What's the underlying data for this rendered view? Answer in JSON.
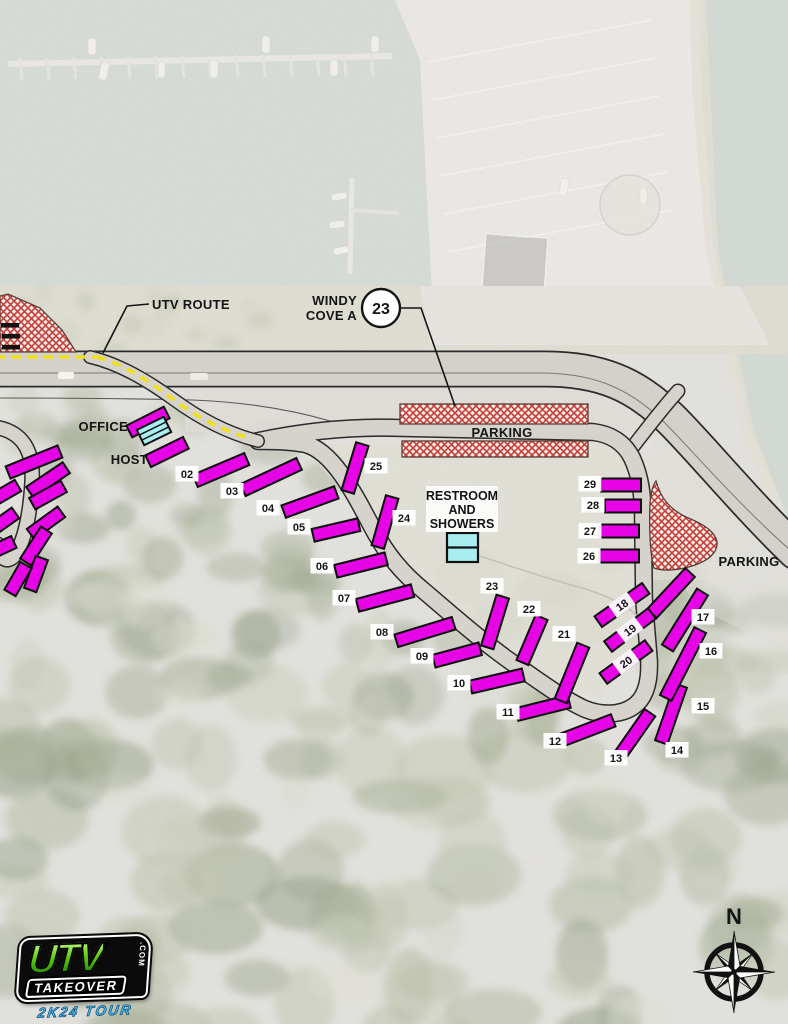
{
  "labels": {
    "utv_route": "UTV ROUTE",
    "windy_line1": "WINDY",
    "windy_line2": "COVE A",
    "cove_number": "23",
    "office": "OFFICE",
    "host": "HOST",
    "parking_top": "PARKING",
    "parking_right": "PARKING",
    "restroom_line1": "RESTROOM",
    "restroom_line2": "AND",
    "restroom_line3": "SHOWERS",
    "north": "N"
  },
  "sites": [
    {
      "n": "02",
      "x": 221,
      "y": 470,
      "len": 56,
      "a": -23,
      "lx": 187,
      "ly": 474,
      "on": false
    },
    {
      "n": "03",
      "x": 271,
      "y": 477,
      "len": 62,
      "a": -25,
      "lx": 232,
      "ly": 491,
      "on": false
    },
    {
      "n": "04",
      "x": 310,
      "y": 502,
      "len": 56,
      "a": -20,
      "lx": 268,
      "ly": 508,
      "on": false
    },
    {
      "n": "05",
      "x": 336,
      "y": 530,
      "len": 47,
      "a": -13,
      "lx": 299,
      "ly": 527,
      "on": false
    },
    {
      "n": "06",
      "x": 361,
      "y": 565,
      "len": 52,
      "a": -14,
      "lx": 322,
      "ly": 566,
      "on": false
    },
    {
      "n": "07",
      "x": 385,
      "y": 598,
      "len": 57,
      "a": -15,
      "lx": 344,
      "ly": 598,
      "on": false
    },
    {
      "n": "08",
      "x": 425,
      "y": 632,
      "len": 60,
      "a": -17,
      "lx": 382,
      "ly": 632,
      "on": false
    },
    {
      "n": "09",
      "x": 457,
      "y": 655,
      "len": 48,
      "a": -15,
      "lx": 422,
      "ly": 656,
      "on": false
    },
    {
      "n": "10",
      "x": 497,
      "y": 681,
      "len": 54,
      "a": -13,
      "lx": 459,
      "ly": 683,
      "on": false
    },
    {
      "n": "11",
      "x": 543,
      "y": 708,
      "len": 54,
      "a": -14,
      "lx": 508,
      "ly": 712,
      "on": false
    },
    {
      "n": "12",
      "x": 588,
      "y": 730,
      "len": 54,
      "a": -21,
      "lx": 555,
      "ly": 741,
      "on": false
    },
    {
      "n": "13",
      "x": 635,
      "y": 734,
      "len": 52,
      "a": -55,
      "lx": 616,
      "ly": 758,
      "on": false
    },
    {
      "n": "14",
      "x": 671,
      "y": 714,
      "len": 60,
      "a": -71,
      "lx": 677,
      "ly": 750,
      "on": false
    },
    {
      "n": "15",
      "x": 683,
      "y": 664,
      "len": 76,
      "a": -63,
      "lx": 703,
      "ly": 706,
      "on": false
    },
    {
      "n": "16",
      "x": 685,
      "y": 620,
      "len": 66,
      "a": -58,
      "lx": 711,
      "ly": 651,
      "on": false
    },
    {
      "n": "17",
      "x": 671,
      "y": 593,
      "len": 56,
      "a": -47,
      "lx": 703,
      "ly": 617,
      "on": false
    },
    {
      "n": "18",
      "x": 622,
      "y": 605,
      "len": 58,
      "a": -35,
      "lx": 622,
      "ly": 605,
      "on": true
    },
    {
      "n": "19",
      "x": 630,
      "y": 630,
      "len": 55,
      "a": -37,
      "lx": 630,
      "ly": 630,
      "on": true
    },
    {
      "n": "20",
      "x": 626,
      "y": 662,
      "len": 56,
      "a": -36,
      "lx": 626,
      "ly": 662,
      "on": true
    },
    {
      "n": "21",
      "x": 572,
      "y": 673,
      "len": 60,
      "a": -68,
      "lx": 564,
      "ly": 634,
      "on": false
    },
    {
      "n": "22",
      "x": 532,
      "y": 640,
      "len": 49,
      "a": -67,
      "lx": 529,
      "ly": 609,
      "on": false
    },
    {
      "n": "23",
      "x": 495,
      "y": 622,
      "len": 53,
      "a": -73,
      "lx": 492,
      "ly": 586,
      "on": false
    },
    {
      "n": "24",
      "x": 385,
      "y": 522,
      "len": 52,
      "a": -74,
      "lx": 404,
      "ly": 518,
      "on": false
    },
    {
      "n": "25",
      "x": 355,
      "y": 468,
      "len": 50,
      "a": -73,
      "lx": 376,
      "ly": 466,
      "on": false
    },
    {
      "n": "26",
      "x": 619,
      "y": 556,
      "len": 40,
      "a": 0,
      "lx": 589,
      "ly": 556,
      "on": false
    },
    {
      "n": "27",
      "x": 619,
      "y": 531,
      "len": 40,
      "a": 0,
      "lx": 590,
      "ly": 531,
      "on": false
    },
    {
      "n": "28",
      "x": 623,
      "y": 506,
      "len": 36,
      "a": 0,
      "lx": 593,
      "ly": 505,
      "on": false
    },
    {
      "n": "29",
      "x": 621,
      "y": 485,
      "len": 40,
      "a": 0,
      "lx": 590,
      "ly": 484,
      "on": false
    }
  ],
  "unnumbered_bars": {
    "host_area": [
      [
        148,
        422,
        42,
        -27
      ],
      [
        167,
        452,
        42,
        -26
      ]
    ],
    "left_edge": [
      [
        34,
        462,
        56,
        -22
      ],
      [
        48,
        480,
        44,
        -34
      ],
      [
        48,
        495,
        36,
        -29
      ],
      [
        46,
        523,
        38,
        -36
      ],
      [
        36,
        546,
        38,
        -57
      ],
      [
        36,
        574,
        34,
        -70
      ],
      [
        18,
        579,
        32,
        -60
      ],
      [
        5,
        493,
        30,
        -30
      ],
      [
        4,
        521,
        28,
        -35
      ],
      [
        3,
        547,
        24,
        -25
      ]
    ]
  },
  "adjacent_black_bars": [
    [
      1,
      323
    ],
    [
      2,
      334
    ],
    [
      2,
      345
    ]
  ],
  "colors": {
    "site_bar": "#E604E6",
    "building": "#A8EDF2",
    "utv_route_dash": "#EFE01A",
    "parking_hatch_line": "#C8403A",
    "parking_hatch_bg": "#F8ECE7",
    "road_fill": "#D6D3CC",
    "road_edge": "#2B2B2B"
  },
  "logo": {
    "brand": "UTV",
    "brand2": "TAKEOVER",
    "suffix": ".COM",
    "tour": "2K24 TOUR"
  }
}
